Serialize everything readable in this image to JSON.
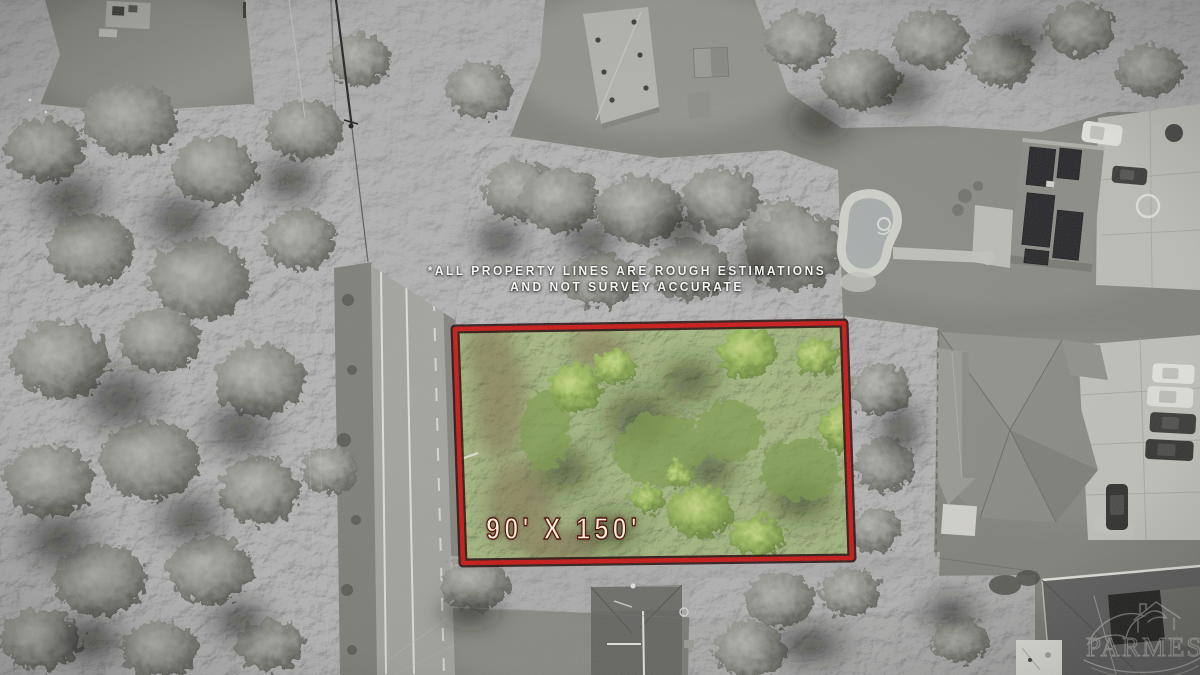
{
  "overlay": {
    "disclaimer_line1": "*ALL PROPERTY LINES ARE ROUGH ESTIMATIONS",
    "disclaimer_line2": "AND NOT SURVEY ACCURATE",
    "lot_dimensions": "90' X 150'"
  },
  "watermark": {
    "text_left": "PAR",
    "text_right": "MES"
  },
  "colors": {
    "lot_border": "#c81715",
    "lot_border_outline": "#1d0402",
    "dimension_text": "#f5edda",
    "dimension_text_stroke": "#5c150c",
    "disclaimer_text": "#f4f4f0",
    "lot_greens": [
      "#52662e",
      "#9cba5e",
      "#c6d885"
    ],
    "photo_tone": "desaturated-gray"
  }
}
